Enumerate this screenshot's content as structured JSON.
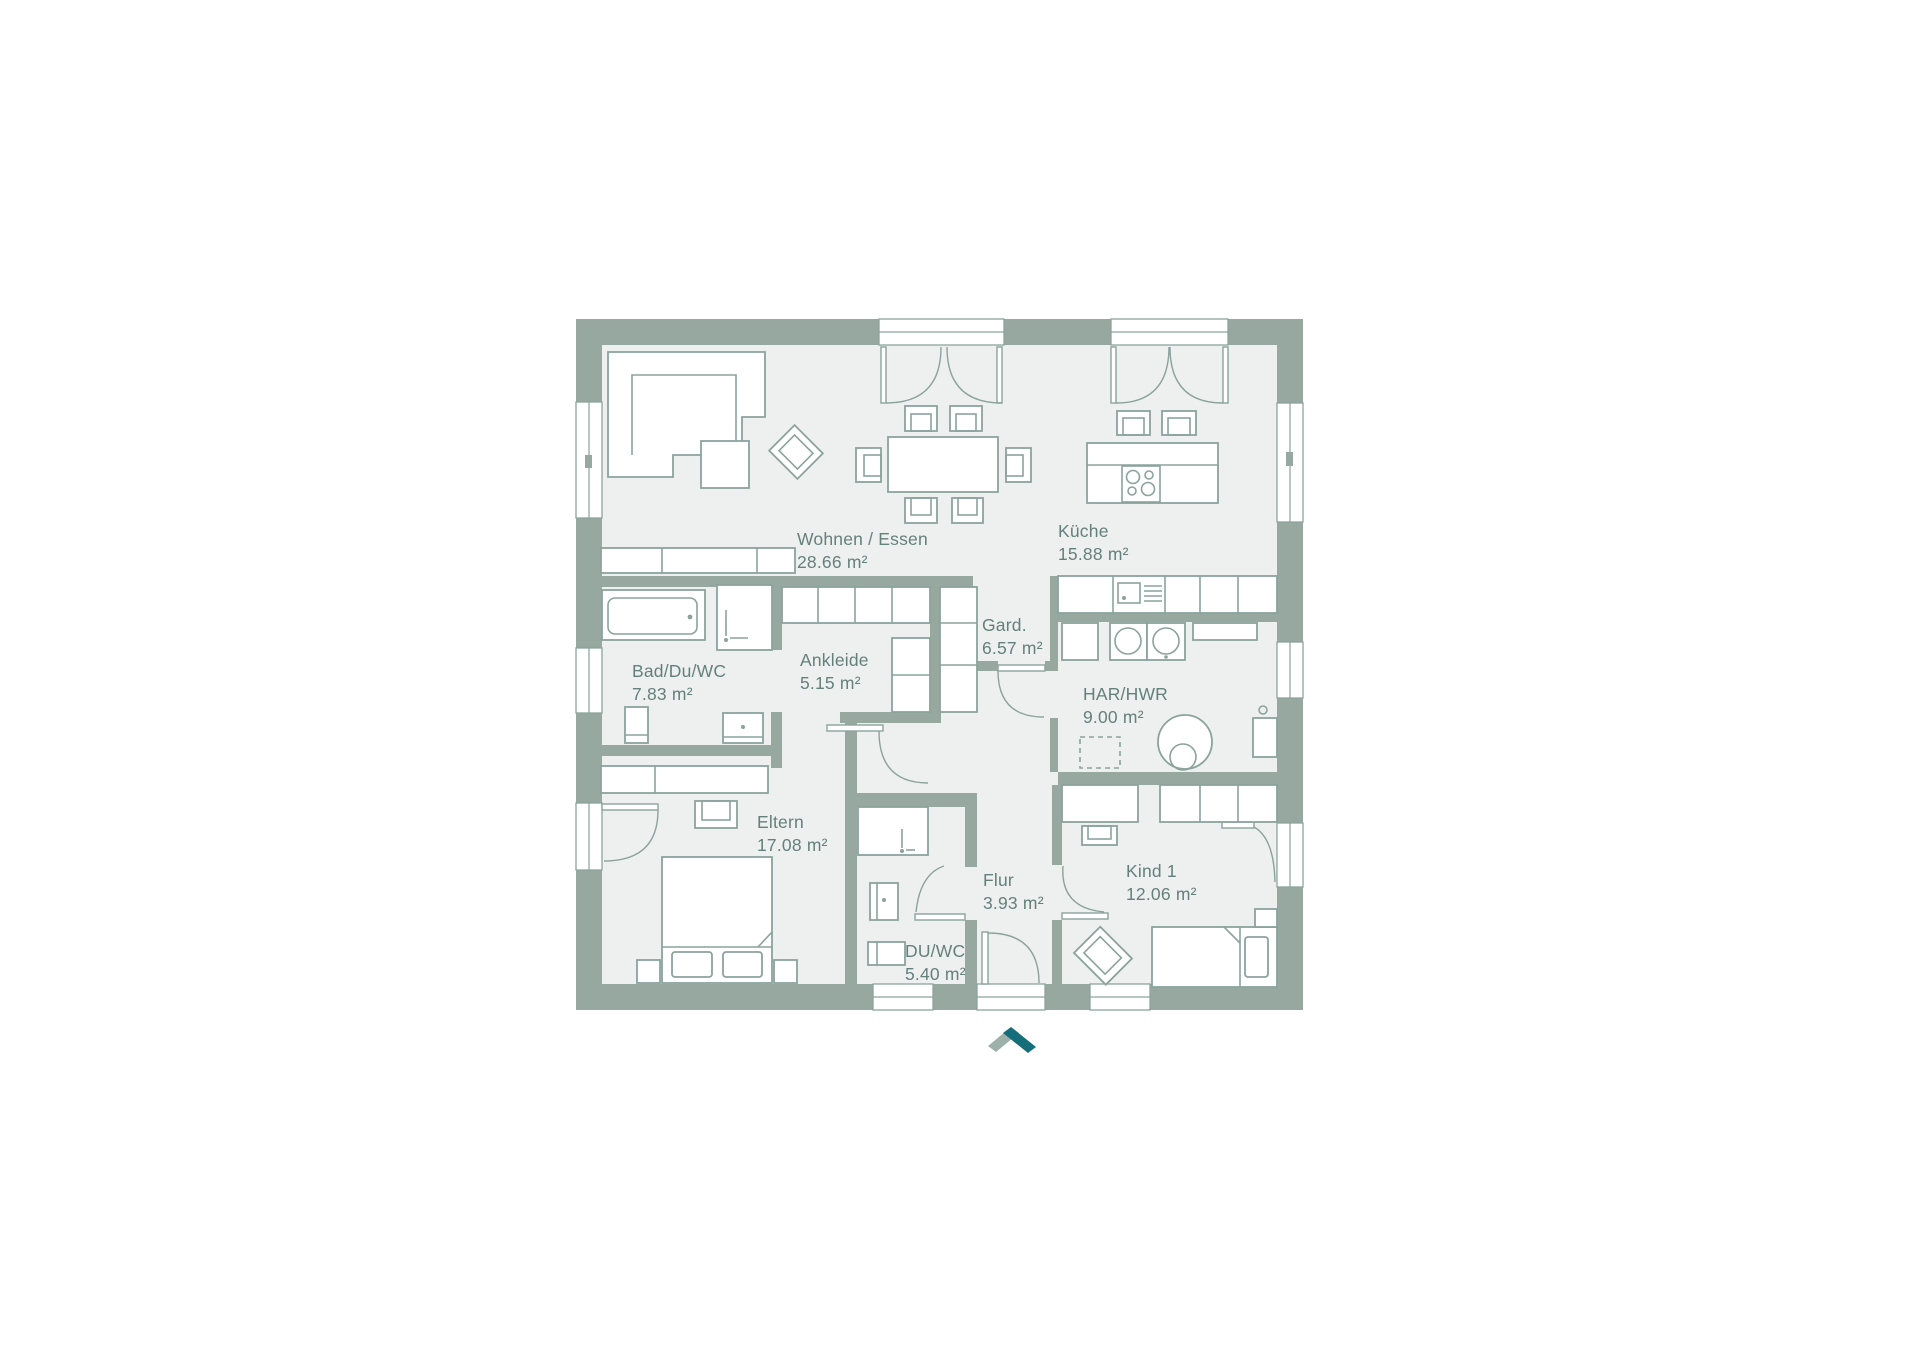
{
  "plan": {
    "rooms": [
      {
        "name": "Wohnen / Essen",
        "area": "28.66 m²"
      },
      {
        "name": "Küche",
        "area": "15.88 m²"
      },
      {
        "name": "Bad/Du/WC",
        "area": "7.83 m²"
      },
      {
        "name": "Ankleide",
        "area": "5.15 m²"
      },
      {
        "name": "Gard.",
        "area": "6.57 m²"
      },
      {
        "name": "HAR/HWR",
        "area": "9.00 m²"
      },
      {
        "name": "Eltern",
        "area": "17.08 m²"
      },
      {
        "name": "Flur",
        "area": "3.93 m²"
      },
      {
        "name": "DU/WC",
        "area": "5.40 m²"
      },
      {
        "name": "Kind 1",
        "area": "12.06 m²"
      }
    ],
    "colors": {
      "wall": "#97a8a0",
      "floor": "#eef0ef",
      "outline": "#8ba39c",
      "text": "#64807b",
      "logo_light": "#9db0a9",
      "logo_teal": "#156e79"
    }
  }
}
